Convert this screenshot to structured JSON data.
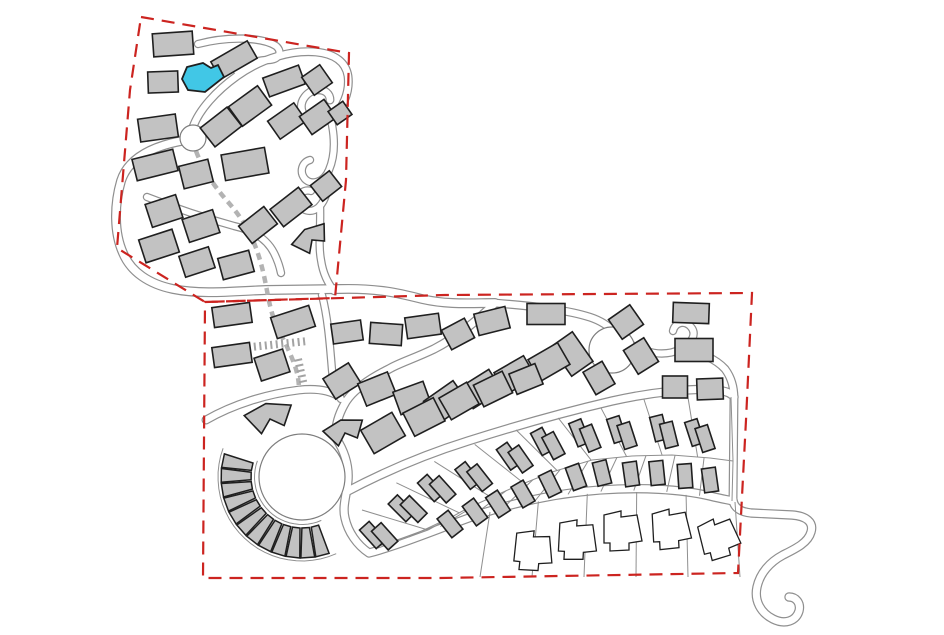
{
  "canvas": {
    "w": 944,
    "h": 635
  },
  "colors": {
    "background": "#ffffff",
    "boundary": "#cc2420",
    "building_fill": "#c2c2c2",
    "building_stroke": "#1f1f1f",
    "road_casing": "#8f8f8f",
    "road_fill": "#ffffff",
    "circle_stroke": "#7d7d7d",
    "plot_line": "#8f8f8f",
    "footpath": "#b3b3b3",
    "stairs": "#a3a3a3",
    "highlight_fill": "#41c7e6",
    "white_house_fill": "#ffffff"
  },
  "boundaries": [
    {
      "name": "upper-parcel-boundary",
      "points": [
        [
          141,
          17
        ],
        [
          349,
          53
        ],
        [
          346,
          180
        ],
        [
          335,
          298
        ],
        [
          205,
          302
        ],
        [
          117,
          248
        ],
        [
          130,
          90
        ]
      ]
    },
    {
      "name": "lower-parcel-boundary",
      "points": [
        [
          205,
          302
        ],
        [
          445,
          295
        ],
        [
          752,
          293
        ],
        [
          746,
          420
        ],
        [
          738,
          573
        ],
        [
          440,
          578
        ],
        [
          203,
          578
        ]
      ]
    }
  ],
  "roads": [
    {
      "d": "M198 44 C228 36 262 37 276 46 C283 52 279 60 268 60 C258 60 246 64 237 71",
      "w": 6
    },
    {
      "d": "M193 127 C199 110 216 91 237 76 C262 58 292 50 316 52 C336 54 346 63 348 76 C350 92 343 109 331 118 C320 126 306 123 302 111 C299 101 307 91 317 90 C325 89 330 94 330 100",
      "w": 6.5
    },
    {
      "d": "M331 120 C335 138 335 156 329 170 C324 182 312 186 305 179 C299 172 302 162 310 160",
      "w": 6
    },
    {
      "d": "M328 172 C329 188 326 200 319 207 C311 214 301 211 299 202 C297 194 304 189 311 191",
      "w": 6
    },
    {
      "d": "M320 206 C321 226 318 244 321 260 C323 274 328 283 334 291",
      "w": 6
    },
    {
      "d": "M147 197 C175 208 205 218 234 226 C256 231 268 241 274 253 C278 261 280 268 281 273",
      "w": 6
    },
    {
      "d": "M181 141 C150 147 128 159 121 181 C114 205 114 233 123 253 C131 272 149 284 173 289 C202 295 236 291 266 290 L340 289 C380 288 402 294 422 299 C448 305 472 303 495 303",
      "w": 7.5
    },
    {
      "d": "M495 303 C479 319 459 336 434 349 C413 359 399 363 389 369 C369 379 351 391 344 405 C338 416 335 427 336 438",
      "w": 7
    },
    {
      "d": "M336 438 C345 452 349 466 348 480 C347 494 342 506 345 518 C348 532 357 545 369 553 C400 545 440 528 480 514 C520 501 560 493 600 490 C640 487 680 489 710 496 C722 499 729 500 733 501",
      "w": 7
    },
    {
      "d": "M346 492 C380 474 420 456 468 441 C515 426 565 412 612 401 C652 392 692 388 716 390 C726 391 731 393 734 397",
      "w": 7
    },
    {
      "d": "M495 303 C530 306 562 309 586 316 C597 319 606 324 612 330",
      "w": 6.5
    },
    {
      "d": "M612 330 C622 339 632 347 646 351 C659 355 671 354 681 349 C692 343 697 334 691 327 C685 320 675 322 673 331",
      "w": 6
    },
    {
      "d": "M681 349 C700 352 716 359 725 369 C731 377 734 386 734 398 L733 500",
      "w": 6.5
    },
    {
      "d": "M733 500 C734 508 741 512 751 513 L792 515 C806 516 814 522 811 532 C808 543 795 549 783 555 C770 562 760 573 757 587 C754 601 761 613 773 619 C785 625 796 621 799 611 C801 603 796 597 789 597",
      "w": 7
    },
    {
      "d": "M206 420 C234 404 267 394 299 390 C317 388 331 391 340 397",
      "w": 6.5
    },
    {
      "d": "M322 295 C328 318 330 346 332 370 C333 383 336 392 341 399",
      "w": 6
    }
  ],
  "circles": [
    {
      "name": "roundabout",
      "cx": 193,
      "cy": 138,
      "r": 13
    },
    {
      "name": "open-space-circle-east",
      "cx": 612,
      "cy": 350,
      "r": 23
    },
    {
      "name": "central-circus",
      "cx": 302,
      "cy": 477,
      "r": 43
    }
  ],
  "fan": {
    "cx": 302,
    "cy": 477,
    "r1": 51,
    "r2": 81,
    "a1": 197,
    "a2": 70,
    "count": 12
  },
  "arc_lines": [
    {
      "cx": 302,
      "cy": 477,
      "r": 47.5,
      "a1": 200,
      "a2": 66
    },
    {
      "cx": 302,
      "cy": 477,
      "r": 84,
      "a1": 200,
      "a2": 66
    }
  ],
  "polylines": [
    {
      "name": "plot-separator-arc",
      "points": [
        [
          428,
          530
        ],
        [
          468,
          508
        ],
        [
          510,
          489
        ],
        [
          552,
          472
        ],
        [
          592,
          460
        ],
        [
          632,
          456
        ],
        [
          672,
          455
        ],
        [
          710,
          458
        ],
        [
          733,
          461
        ]
      ]
    }
  ],
  "radial_sets": [
    {
      "from": [
        [
          362,
          510
        ],
        [
          410,
          472
        ],
        [
          470,
          446
        ],
        [
          530,
          425
        ],
        [
          590,
          410
        ],
        [
          650,
          398
        ],
        [
          700,
          393
        ],
        [
          731,
          397
        ]
      ],
      "to": [
        [
          428,
          530
        ],
        [
          468,
          508
        ],
        [
          510,
          489
        ],
        [
          552,
          472
        ],
        [
          592,
          460
        ],
        [
          632,
          456
        ],
        [
          672,
          455
        ],
        [
          710,
          458
        ],
        [
          733,
          461
        ]
      ],
      "count": 10
    },
    {
      "from": [
        [
          428,
          530
        ],
        [
          468,
          508
        ],
        [
          510,
          489
        ],
        [
          552,
          472
        ],
        [
          592,
          460
        ],
        [
          632,
          456
        ],
        [
          672,
          455
        ],
        [
          710,
          458
        ],
        [
          733,
          461
        ]
      ],
      "to": [
        [
          378,
          548
        ],
        [
          420,
          533
        ],
        [
          470,
          517
        ],
        [
          520,
          503
        ],
        [
          570,
          494
        ],
        [
          620,
          490
        ],
        [
          670,
          492
        ],
        [
          710,
          497
        ],
        [
          732,
          501
        ]
      ],
      "count": 12
    },
    {
      "from": [
        [
          490,
          512
        ],
        [
          545,
          500
        ],
        [
          600,
          492
        ],
        [
          655,
          492
        ],
        [
          710,
          497
        ],
        [
          735,
          502
        ]
      ],
      "to": [
        [
          480,
          577
        ],
        [
          535,
          577
        ],
        [
          595,
          577
        ],
        [
          652,
          577
        ],
        [
          706,
          577
        ],
        [
          740,
          577
        ]
      ],
      "count": 6
    }
  ],
  "footpaths": [
    {
      "d": "M196 151 C203 170 214 186 228 202 C242 218 250 232 256 248 C262 264 265 280 268 296 C271 312 275 324 280 333 C286 344 291 355 295 366 C298 375 299 383 299 390",
      "w": 4.5,
      "dash": "7 5"
    }
  ],
  "stairs": [
    {
      "x1": 232,
      "y1": 349,
      "x2": 308,
      "y2": 341
    },
    {
      "x1": 298,
      "y1": 359,
      "x2": 304,
      "y2": 386
    }
  ],
  "buildings": [
    {
      "x": 173,
      "y": 44,
      "rot": -4,
      "w": 40,
      "h": 23
    },
    {
      "x": 163,
      "y": 82,
      "rot": -2,
      "w": 30,
      "h": 21
    },
    {
      "x": 234,
      "y": 60,
      "rot": -30,
      "w": 42,
      "h": 20
    },
    {
      "x": 284,
      "y": 81,
      "rot": -20,
      "w": 38,
      "h": 20
    },
    {
      "x": 317,
      "y": 80,
      "rot": -35,
      "w": 22,
      "h": 22
    },
    {
      "x": 250,
      "y": 106,
      "rot": -36,
      "w": 36,
      "h": 24
    },
    {
      "x": 221,
      "y": 127,
      "rot": -38,
      "w": 34,
      "h": 24
    },
    {
      "x": 158,
      "y": 128,
      "rot": -8,
      "w": 38,
      "h": 23
    },
    {
      "x": 287,
      "y": 121,
      "rot": -35,
      "w": 32,
      "h": 22
    },
    {
      "x": 318,
      "y": 117,
      "rot": -35,
      "w": 30,
      "h": 22
    },
    {
      "x": 340,
      "y": 113,
      "rot": -35,
      "w": 18,
      "h": 16
    },
    {
      "x": 155,
      "y": 165,
      "rot": -14,
      "w": 42,
      "h": 22
    },
    {
      "x": 196,
      "y": 174,
      "rot": -14,
      "w": 30,
      "h": 23
    },
    {
      "x": 245,
      "y": 164,
      "rot": -10,
      "w": 44,
      "h": 26
    },
    {
      "x": 326,
      "y": 186,
      "rot": -38,
      "w": 24,
      "h": 20
    },
    {
      "x": 291,
      "y": 207,
      "rot": -38,
      "w": 36,
      "h": 22
    },
    {
      "x": 258,
      "y": 225,
      "rot": -38,
      "w": 32,
      "h": 22
    },
    {
      "x": 164,
      "y": 211,
      "rot": -18,
      "w": 32,
      "h": 24
    },
    {
      "x": 201,
      "y": 226,
      "rot": -18,
      "w": 32,
      "h": 24
    },
    {
      "x": 159,
      "y": 246,
      "rot": -18,
      "w": 35,
      "h": 24
    },
    {
      "x": 197,
      "y": 262,
      "rot": -18,
      "w": 31,
      "h": 22
    },
    {
      "x": 236,
      "y": 265,
      "rot": -15,
      "w": 32,
      "h": 22
    },
    {
      "x": 232,
      "y": 315,
      "rot": -8,
      "w": 38,
      "h": 20
    },
    {
      "x": 293,
      "y": 322,
      "rot": -18,
      "w": 40,
      "h": 22
    },
    {
      "x": 232,
      "y": 355,
      "rot": -8,
      "w": 38,
      "h": 20
    },
    {
      "x": 272,
      "y": 365,
      "rot": -18,
      "w": 30,
      "h": 24
    },
    {
      "x": 347,
      "y": 332,
      "rot": -8,
      "w": 30,
      "h": 20
    },
    {
      "x": 386,
      "y": 334,
      "rot": 4,
      "w": 32,
      "h": 21
    },
    {
      "x": 423,
      "y": 326,
      "rot": -8,
      "w": 34,
      "h": 21
    },
    {
      "x": 458,
      "y": 334,
      "rot": -28,
      "w": 26,
      "h": 22
    },
    {
      "x": 492,
      "y": 321,
      "rot": -14,
      "w": 32,
      "h": 22
    },
    {
      "x": 546,
      "y": 314,
      "rot": 0,
      "w": 38,
      "h": 21
    },
    {
      "x": 691,
      "y": 313,
      "rot": 2,
      "w": 36,
      "h": 20
    },
    {
      "x": 626,
      "y": 322,
      "rot": -35,
      "w": 26,
      "h": 24
    },
    {
      "x": 641,
      "y": 356,
      "rot": -32,
      "w": 24,
      "h": 28
    },
    {
      "x": 599,
      "y": 378,
      "rot": -30,
      "w": 22,
      "h": 26
    },
    {
      "x": 572,
      "y": 354,
      "rot": -35,
      "w": 26,
      "h": 36
    },
    {
      "x": 694,
      "y": 350,
      "rot": 0,
      "w": 38,
      "h": 23
    },
    {
      "x": 675,
      "y": 387,
      "rot": 0,
      "w": 25,
      "h": 22
    },
    {
      "x": 710,
      "y": 389,
      "rot": -2,
      "w": 26,
      "h": 21
    },
    {
      "x": 342,
      "y": 381,
      "rot": -32,
      "w": 30,
      "h": 24
    },
    {
      "x": 377,
      "y": 389,
      "rot": -22,
      "w": 32,
      "h": 24
    },
    {
      "x": 412,
      "y": 398,
      "rot": -20,
      "w": 32,
      "h": 24
    },
    {
      "x": 446,
      "y": 402,
      "rot": -35,
      "w": 36,
      "h": 27
    },
    {
      "x": 481,
      "y": 389,
      "rot": -32,
      "w": 34,
      "h": 25
    },
    {
      "x": 515,
      "y": 375,
      "rot": -30,
      "w": 34,
      "h": 25
    },
    {
      "x": 549,
      "y": 362,
      "rot": -30,
      "w": 34,
      "h": 25
    },
    {
      "x": 383,
      "y": 433,
      "rot": -30,
      "w": 36,
      "h": 27
    },
    {
      "x": 424,
      "y": 417,
      "rot": -27,
      "w": 34,
      "h": 26
    },
    {
      "x": 459,
      "y": 401,
      "rot": -30,
      "w": 32,
      "h": 25
    },
    {
      "x": 493,
      "y": 389,
      "rot": -26,
      "w": 32,
      "h": 24
    },
    {
      "x": 526,
      "y": 379,
      "rot": -22,
      "w": 28,
      "h": 22
    }
  ],
  "chevrons": [
    {
      "x": 270,
      "y": 419,
      "rot": -15,
      "s": 1.0
    },
    {
      "x": 345,
      "y": 433,
      "rot": -18,
      "s": 0.85
    },
    {
      "x": 312,
      "y": 240,
      "rot": -35,
      "s": 0.8
    }
  ],
  "chevron_shape": [
    [
      -24,
      -10
    ],
    [
      0,
      -16
    ],
    [
      24,
      -8
    ],
    [
      12,
      10
    ],
    [
      0,
      0
    ],
    [
      -12,
      12
    ]
  ],
  "pairs": [
    {
      "x": 379,
      "y": 536,
      "rot": -42
    },
    {
      "x": 408,
      "y": 509,
      "rot": -45
    },
    {
      "x": 437,
      "y": 489,
      "rot": -42
    },
    {
      "x": 474,
      "y": 477,
      "rot": -38
    },
    {
      "x": 515,
      "y": 458,
      "rot": -35
    },
    {
      "x": 548,
      "y": 444,
      "rot": -28
    },
    {
      "x": 585,
      "y": 436,
      "rot": -22
    },
    {
      "x": 622,
      "y": 433,
      "rot": -18
    },
    {
      "x": 664,
      "y": 432,
      "rot": -14
    },
    {
      "x": 700,
      "y": 436,
      "rot": -18
    }
  ],
  "pair_size": {
    "w": 13,
    "h": 25
  },
  "singles": [
    {
      "x": 450,
      "y": 524,
      "rot": -38
    },
    {
      "x": 475,
      "y": 512,
      "rot": -36
    },
    {
      "x": 498,
      "y": 504,
      "rot": -33
    },
    {
      "x": 523,
      "y": 494,
      "rot": -30
    },
    {
      "x": 550,
      "y": 484,
      "rot": -26
    },
    {
      "x": 576,
      "y": 477,
      "rot": -20
    },
    {
      "x": 602,
      "y": 473,
      "rot": -14
    },
    {
      "x": 631,
      "y": 474,
      "rot": -8
    },
    {
      "x": 657,
      "y": 473,
      "rot": -6
    },
    {
      "x": 685,
      "y": 476,
      "rot": -4
    },
    {
      "x": 710,
      "y": 480,
      "rot": -8
    }
  ],
  "single_size": {
    "w": 14,
    "h": 24
  },
  "white_houses": [
    {
      "x": 534,
      "y": 551,
      "rot": 6
    },
    {
      "x": 578,
      "y": 540,
      "rot": 3
    },
    {
      "x": 623,
      "y": 531,
      "rot": 0
    },
    {
      "x": 672,
      "y": 529,
      "rot": -3
    },
    {
      "x": 720,
      "y": 538,
      "rot": -14
    }
  ],
  "white_house_shape": [
    [
      -19,
      -16
    ],
    [
      -2,
      -20
    ],
    [
      -2,
      -14
    ],
    [
      14,
      -16
    ],
    [
      19,
      10
    ],
    [
      6,
      12
    ],
    [
      6,
      19
    ],
    [
      -13,
      20
    ],
    [
      -13,
      12
    ],
    [
      -19,
      12
    ]
  ],
  "highlight_building": {
    "points": [
      [
        182,
        79
      ],
      [
        187,
        67
      ],
      [
        203,
        63
      ],
      [
        211,
        68
      ],
      [
        218,
        65
      ],
      [
        224,
        77
      ],
      [
        205,
        92
      ],
      [
        188,
        90
      ]
    ]
  }
}
